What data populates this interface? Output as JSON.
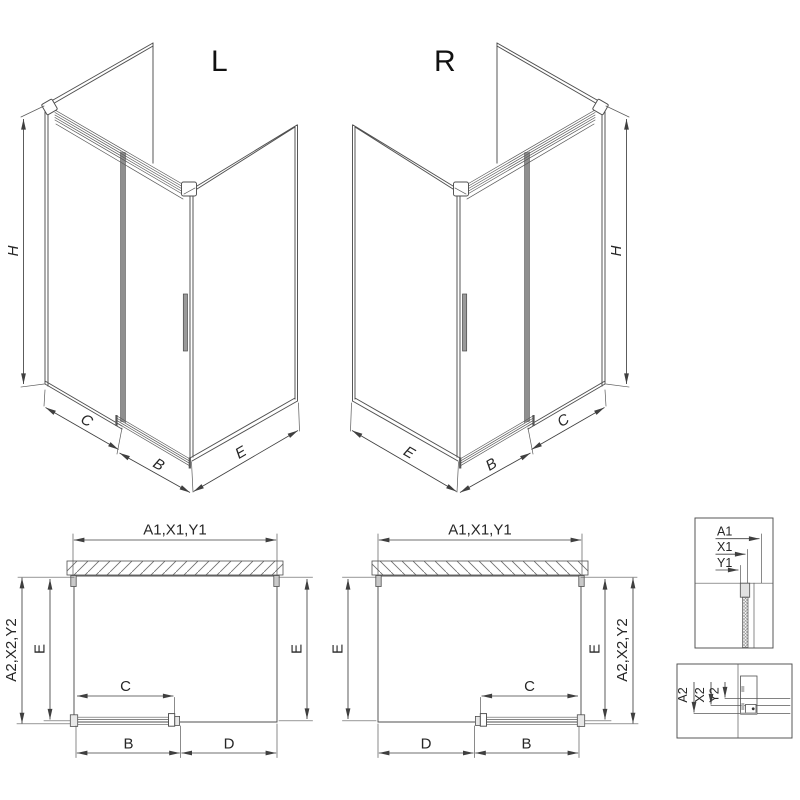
{
  "drawing": {
    "iso_left": {
      "variant": "L",
      "dim_h": "H",
      "dim_c": "C",
      "dim_b": "B",
      "dim_e": "E"
    },
    "iso_right": {
      "variant": "R",
      "dim_h": "H",
      "dim_c": "C",
      "dim_b": "B",
      "dim_e": "E"
    },
    "plan_left": {
      "dim_top": "A1,X1,Y1",
      "dim_side_outer": "A2,X2,Y2",
      "dim_e_left": "E",
      "dim_e_right": "E",
      "dim_c": "C",
      "dim_b": "B",
      "dim_d": "D"
    },
    "plan_right": {
      "dim_top": "A1,X1,Y1",
      "dim_side_outer": "A2,X2,Y2",
      "dim_e_left": "E",
      "dim_e_right": "E",
      "dim_c": "C",
      "dim_b": "B",
      "dim_d": "D"
    },
    "detail_top": {
      "dim_a1": "A1",
      "dim_x1": "X1",
      "dim_y1": "Y1"
    },
    "detail_bottom": {
      "dim_a2": "A2",
      "dim_x2": "X2",
      "dim_y2": "Y2"
    }
  },
  "colors": {
    "background": "#ffffff",
    "line": "#4f4f4f",
    "dim_line": "#3f3f3f",
    "text": "#262626",
    "door_gray": "#8f8f8f",
    "profile_fill": "#e8e8e8"
  }
}
